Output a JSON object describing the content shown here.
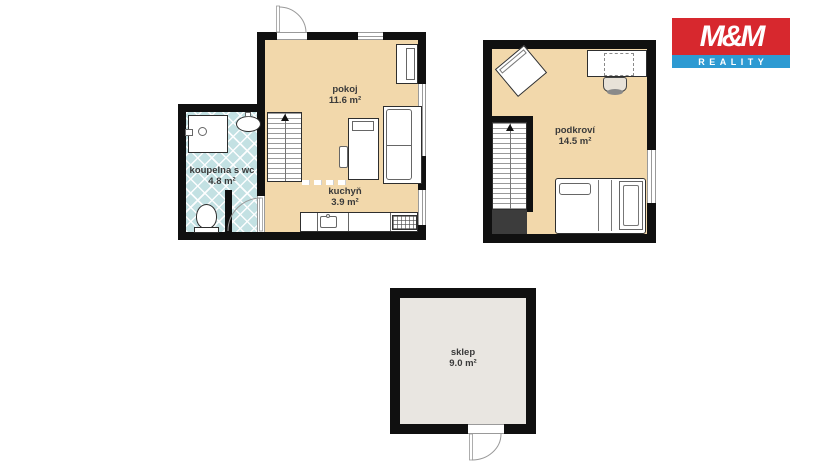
{
  "logo": {
    "title": "M&M",
    "subtitle": "REALITY",
    "red": "#d7282e",
    "blue": "#2d9ad2"
  },
  "palette": {
    "wall": "#101010",
    "room_floor": "#f2d8ab",
    "bathroom_tile": "#c3e1e3",
    "cellar_floor": "#e9e6e1",
    "label_text": "#3a3a3a",
    "understairs": "#3c3c3c"
  },
  "floors": {
    "ground": {
      "rooms": [
        {
          "label": "pokoj",
          "area": "11.6 m²"
        },
        {
          "label": "kuchyň",
          "area": "3.9 m²"
        },
        {
          "label": "koupelna s wc",
          "area": "4.8 m²"
        }
      ]
    },
    "attic": {
      "rooms": [
        {
          "label": "podkroví",
          "area": "14.5 m²"
        }
      ]
    },
    "cellar": {
      "rooms": [
        {
          "label": "sklep",
          "area": "9.0 m²"
        }
      ]
    }
  }
}
